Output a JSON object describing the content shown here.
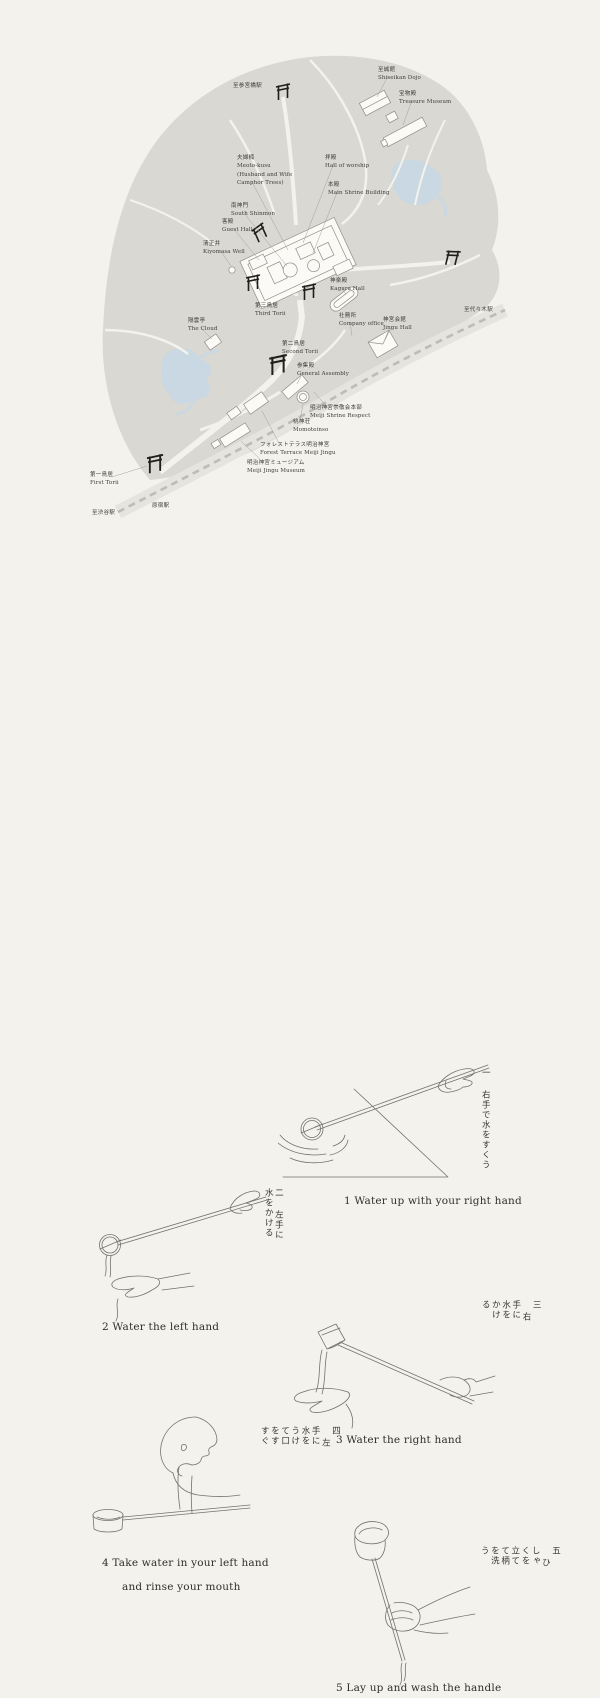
{
  "title": "Meiji Jingu map and temizuya purification steps",
  "colors": {
    "background": "#f3f2ec",
    "forest": "#d9d8d2",
    "water": "#c9d8e2",
    "building_fill": "#fbfaf6",
    "ink": "#1e1e1c",
    "text": "#3d3d39"
  },
  "map": {
    "labels": [
      {
        "id": "to-sangubashi-station",
        "x": 233,
        "y": 82,
        "jp": "至参宮橋駅",
        "en": []
      },
      {
        "id": "shiseikan-dojo",
        "x": 378,
        "y": 66,
        "jp": "至誠館",
        "en": [
          "Shiseikan Dojo"
        ]
      },
      {
        "id": "treasure-museum",
        "x": 399,
        "y": 90,
        "jp": "宝物殿",
        "en": [
          "Treasure Museum"
        ]
      },
      {
        "id": "meoto-kusu",
        "x": 237,
        "y": 154,
        "jp": "夫婦楠",
        "en": [
          "Meoto-kusu",
          "(Husband and Wife",
          "Camphor Trees)"
        ]
      },
      {
        "id": "hall-of-worship",
        "x": 325,
        "y": 154,
        "jp": "拝殿",
        "en": [
          "Hall of worship"
        ]
      },
      {
        "id": "main-shrine-building",
        "x": 328,
        "y": 181,
        "jp": "本殿",
        "en": [
          "Main Shrine Building"
        ]
      },
      {
        "id": "south-shinmon",
        "x": 231,
        "y": 202,
        "jp": "南神門",
        "en": [
          "South Shinmon"
        ]
      },
      {
        "id": "guest-hall",
        "x": 222,
        "y": 218,
        "jp": "客殿",
        "en": [
          "Guest Hall"
        ]
      },
      {
        "id": "kiyomasa-well",
        "x": 203,
        "y": 240,
        "jp": "清正井",
        "en": [
          "Kiyomasa Well"
        ]
      },
      {
        "id": "kagura-hall",
        "x": 330,
        "y": 277,
        "jp": "神楽殿",
        "en": [
          "Kagura Hall"
        ]
      },
      {
        "id": "third-torii",
        "x": 255,
        "y": 302,
        "jp": "第三鳥居",
        "en": [
          "Third Torii"
        ]
      },
      {
        "id": "the-cloud",
        "x": 188,
        "y": 317,
        "jp": "隔雲亭",
        "en": [
          "The Cloud"
        ]
      },
      {
        "id": "company-office",
        "x": 339,
        "y": 312,
        "jp": "社務所",
        "en": [
          "Company office"
        ]
      },
      {
        "id": "jingu-hall",
        "x": 383,
        "y": 316,
        "jp": "神宮会館",
        "en": [
          "Jingu Hall"
        ]
      },
      {
        "id": "second-torii",
        "x": 282,
        "y": 340,
        "jp": "第二鳥居",
        "en": [
          "Second Torii"
        ]
      },
      {
        "id": "general-assembly",
        "x": 297,
        "y": 362,
        "jp": "参集殿",
        "en": [
          "General Assembly"
        ]
      },
      {
        "id": "meiji-shrine-respect",
        "x": 310,
        "y": 404,
        "jp": "明治神宮崇敬会本部",
        "en": [
          "Meiji Shrine Respect"
        ]
      },
      {
        "id": "momoteinso",
        "x": 293,
        "y": 418,
        "jp": "桃神荘",
        "en": [
          "Momoteinso"
        ]
      },
      {
        "id": "forest-terrace",
        "x": 260,
        "y": 441,
        "jp": "フォレストテラス明治神宮",
        "en": [
          "Forest Terrace Meiji Jingu"
        ]
      },
      {
        "id": "meiji-jingu-museum",
        "x": 247,
        "y": 459,
        "jp": "明治神宮ミュージアム",
        "en": [
          "Meiji Jingu Museum"
        ]
      },
      {
        "id": "first-torii",
        "x": 90,
        "y": 471,
        "jp": "第一鳥居",
        "en": [
          "First Torii"
        ]
      },
      {
        "id": "harajuku-station",
        "x": 152,
        "y": 502,
        "jp": "原宿駅",
        "en": []
      },
      {
        "id": "to-shibuya-station",
        "x": 92,
        "y": 509,
        "jp": "至渋谷駅",
        "en": []
      },
      {
        "id": "to-yoyogi-station",
        "x": 464,
        "y": 306,
        "jp": "至代々木駅",
        "en": []
      }
    ]
  },
  "steps": [
    {
      "kanji": "一",
      "jp": "右手で水をすくう",
      "caption": "1  Water up with your right hand"
    },
    {
      "kanji": "二",
      "jp": "左手に水をかける",
      "caption": "2  Water the left hand"
    },
    {
      "kanji": "三",
      "jp": "右手に水をかける",
      "caption": "3  Water the right hand"
    },
    {
      "kanji": "四",
      "jp": "左手に水をうけて口をすすぐ",
      "caption": "4  Take water in your left hand",
      "caption2": "and rinse your mouth"
    },
    {
      "kanji": "五",
      "jp": "ひしゃくを立てて柄を洗う",
      "caption": "5  Lay up and wash the handle"
    }
  ]
}
